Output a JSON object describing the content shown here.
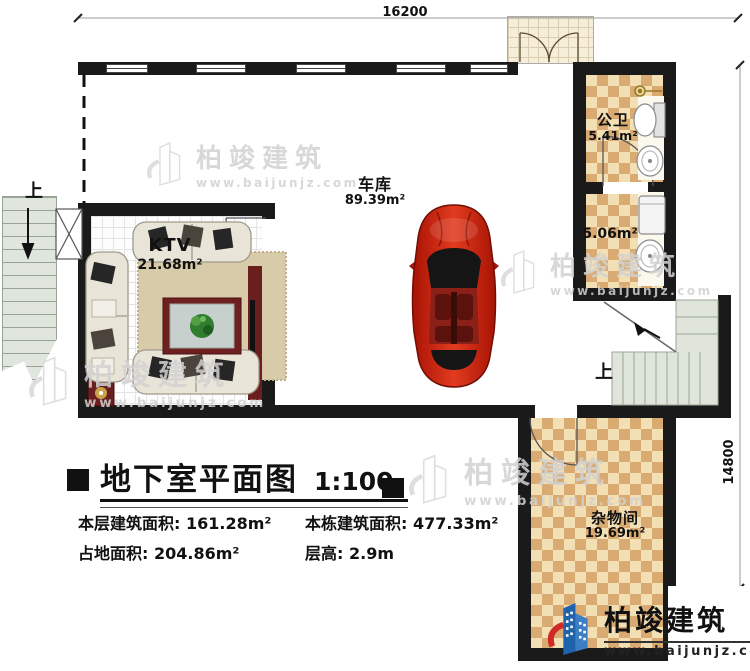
{
  "dimensions": {
    "top": "16200",
    "right": "14800"
  },
  "rooms": {
    "garage": {
      "name": "车库",
      "area": "89.39m²"
    },
    "ktv": {
      "name": "KTV",
      "area": "21.68m²"
    },
    "public_bath": {
      "name": "公卫",
      "area": "5.41m²"
    },
    "bath2": {
      "area": "5.06m²"
    },
    "storage": {
      "name": "杂物间",
      "area": "19.69m²"
    }
  },
  "stairs": {
    "exterior_label": "上",
    "interior_label": "上"
  },
  "title_block": {
    "title": "地下室平面图",
    "scale": "1:100",
    "stats": [
      {
        "label": "本层建筑面积:",
        "value": "161.28m²"
      },
      {
        "label": "本栋建筑面积:",
        "value": "477.33m²"
      },
      {
        "label": "占地面积:",
        "value": "204.86m²"
      },
      {
        "label": "层高:",
        "value": "2.9m"
      }
    ]
  },
  "watermark": {
    "name": "柏竣建筑",
    "url": "www.baijunjz.com"
  },
  "logo": {
    "name": "柏竣建筑",
    "url": "www.baijunjz.com"
  },
  "colors": {
    "wall": "#1a1a1a",
    "tile_light": "#f2dfb4",
    "tile_dark": "#d9ab72",
    "stair": "#dfe5db",
    "car_red": "#c21a08",
    "logo_blue": "#1f63ad",
    "logo_red": "#cf2b24",
    "watermark_gray": "#d2d2d2"
  }
}
